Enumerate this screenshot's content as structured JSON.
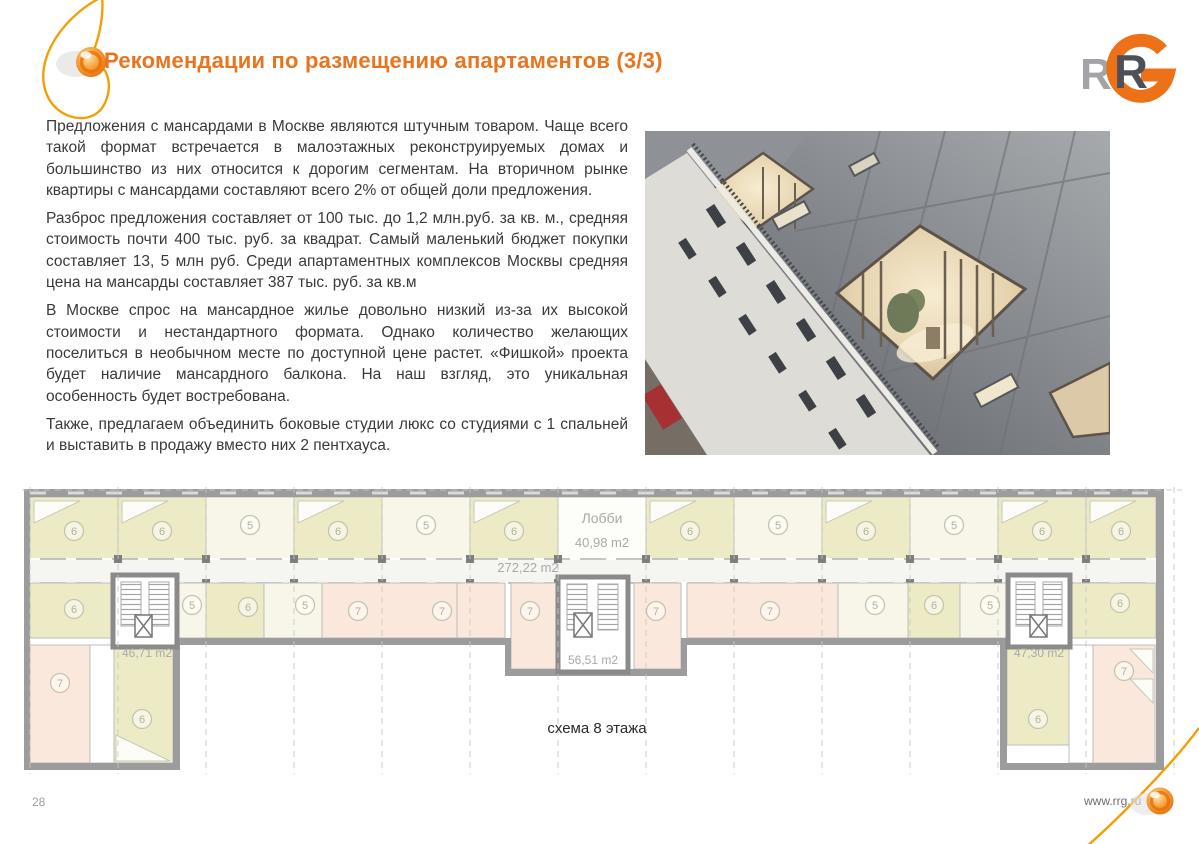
{
  "slide": {
    "title": "Рекомендации по размещению апартаментов (3/3)",
    "page_number": "28",
    "website_url": "www.rrg.ru",
    "logo": {
      "gray_r": "R",
      "dark_r": "R"
    }
  },
  "article": {
    "paragraphs": [
      "Предложения с мансардами в Москве являются штучным товаром. Чаще всего такой формат встречается в малоэтажных реконструируемых домах и большинство из них относится к дорогим сегментам. На вторичном рынке квартиры с мансардами составляют всего 2% от общей доли предложения.",
      "Разброс предложения составляет от 100 тыс. до 1,2 млн.руб. за кв. м., средняя стоимость почти 400 тыс. руб. за квадрат. Самый маленький бюджет покупки составляет 13, 5 млн руб. Среди апартаментных комплексов  Москвы средняя цена на мансарды составляет 387 тыс. руб. за кв.м",
      "В Москве спрос на мансардное жилье довольно низкий из-за их высокой стоимости и нестандартного формата. Однако количество желающих поселиться в необычном месте по доступной цене растет. «Фишкой» проекта будет наличие мансардного балкона. На наш взгляд, это уникальная особенность будет востребована.",
      "Также, предлагаем объединить боковые студии люкс со студиями с 1 спальней и выставить в продажу вместо них 2 пентхауса."
    ]
  },
  "floor_plan": {
    "caption": "схема 8 этажа",
    "labels": {
      "lobby_title": "Лобби",
      "lobby_area": "40,98 m2",
      "corridor_area": "272,22 m2",
      "left_stair_area": "46,71 m2",
      "center_stair_area": "56,51 m2",
      "right_stair_area": "47,30 m2"
    },
    "room_badges": [
      {
        "n": "6",
        "x": 52,
        "y": 44
      },
      {
        "n": "6",
        "x": 140,
        "y": 44
      },
      {
        "n": "5",
        "x": 228,
        "y": 38
      },
      {
        "n": "6",
        "x": 316,
        "y": 44
      },
      {
        "n": "5",
        "x": 404,
        "y": 38
      },
      {
        "n": "6",
        "x": 492,
        "y": 44
      },
      {
        "n": "6",
        "x": 668,
        "y": 44
      },
      {
        "n": "5",
        "x": 756,
        "y": 38
      },
      {
        "n": "6",
        "x": 844,
        "y": 44
      },
      {
        "n": "5",
        "x": 932,
        "y": 38
      },
      {
        "n": "6",
        "x": 1020,
        "y": 44
      },
      {
        "n": "6",
        "x": 1099,
        "y": 44
      },
      {
        "n": "6",
        "x": 52,
        "y": 122
      },
      {
        "n": "5",
        "x": 170,
        "y": 118
      },
      {
        "n": "6",
        "x": 226,
        "y": 120
      },
      {
        "n": "5",
        "x": 283,
        "y": 118
      },
      {
        "n": "7",
        "x": 336,
        "y": 124
      },
      {
        "n": "7",
        "x": 420,
        "y": 124
      },
      {
        "n": "7",
        "x": 508,
        "y": 124
      },
      {
        "n": "7",
        "x": 634,
        "y": 124
      },
      {
        "n": "7",
        "x": 748,
        "y": 124
      },
      {
        "n": "5",
        "x": 853,
        "y": 118
      },
      {
        "n": "6",
        "x": 912,
        "y": 118
      },
      {
        "n": "5",
        "x": 968,
        "y": 118
      },
      {
        "n": "6",
        "x": 1098,
        "y": 116
      },
      {
        "n": "7",
        "x": 38,
        "y": 196
      },
      {
        "n": "6",
        "x": 120,
        "y": 232
      },
      {
        "n": "6",
        "x": 1016,
        "y": 232
      },
      {
        "n": "7",
        "x": 1102,
        "y": 184
      }
    ]
  },
  "colors": {
    "accent_orange": "#E8741E",
    "wall_gray": "#9c9c9c",
    "room_khaki": "#ECEBC6",
    "room_cream": "#F8F6E9",
    "room_pink": "#FBE8DC",
    "badge_stroke": "#C6C5AC"
  }
}
